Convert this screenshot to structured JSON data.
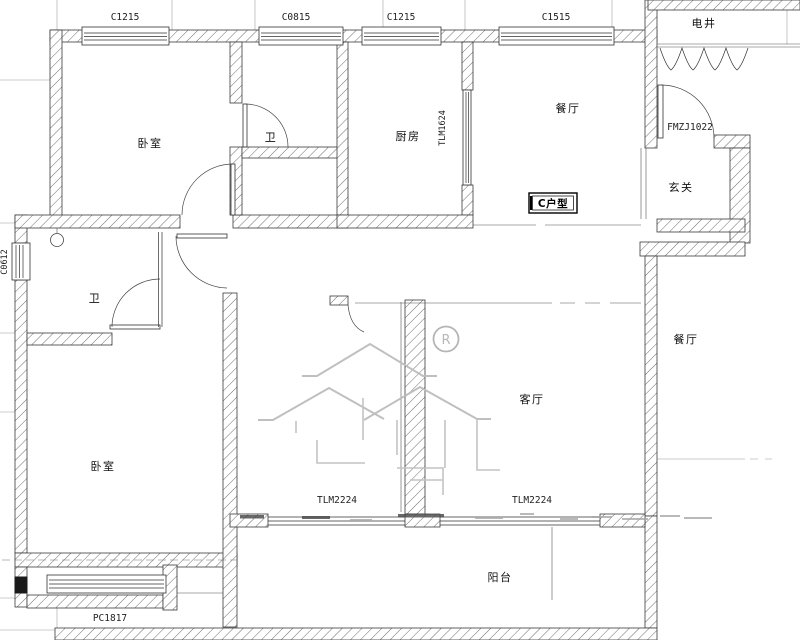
{
  "plan": {
    "unit": {
      "type_label": "C户型"
    },
    "rooms": {
      "bedroom_top": "卧室",
      "bath_top": "卫",
      "kitchen": "厨房",
      "dining_top": "餐厅",
      "electric_shaft": "电井",
      "foyer": "玄关",
      "bath_mid": "卫",
      "bedroom_bottom": "卧室",
      "living": "客厅",
      "dining_right": "餐厅",
      "balcony": "阳台"
    },
    "windows": {
      "top_1": "C1215",
      "top_2": "C0815",
      "top_3": "C1215",
      "top_4": "C1515",
      "bay_bottom": "PC1817",
      "side_left": "C0612"
    },
    "doors": {
      "entry": "FMZJ1022",
      "kitchen_sliding": "TLM1624",
      "balcony_sliding_left": "TLM2224",
      "balcony_sliding_right": "TLM2224"
    },
    "watermark": {
      "registered": "R"
    }
  }
}
